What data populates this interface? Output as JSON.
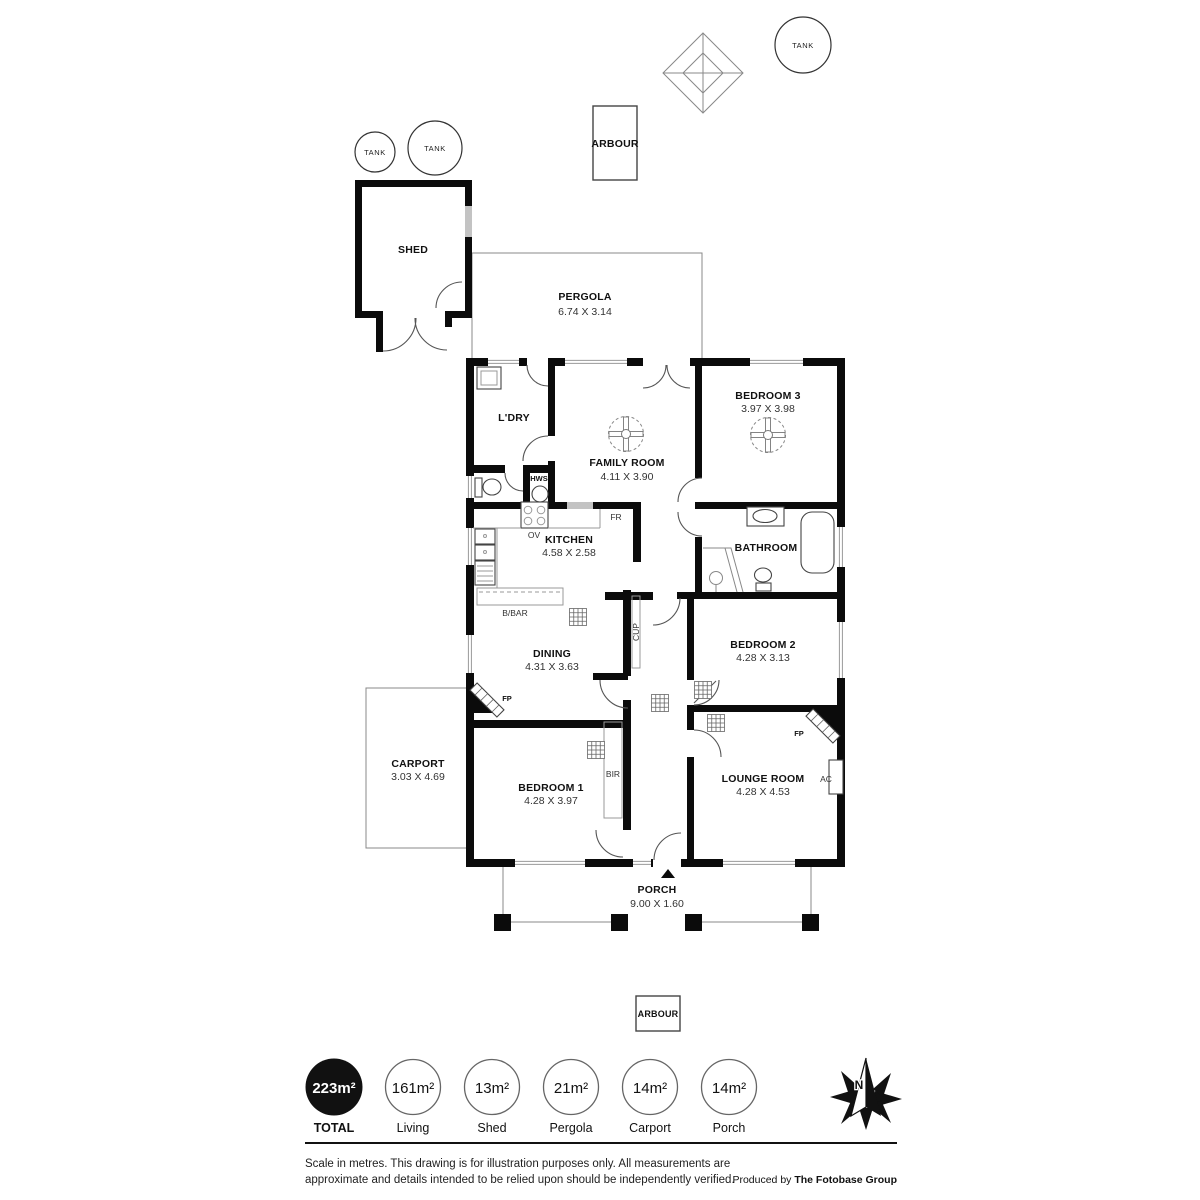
{
  "plan": {
    "tanks": [
      {
        "label": "TANK"
      },
      {
        "label": "TANK"
      },
      {
        "label": "TANK"
      }
    ],
    "arbour_top": {
      "label": "ARBOUR"
    },
    "arbour_bottom": {
      "label": "ARBOUR"
    },
    "shed": {
      "name": "SHED"
    },
    "pergola": {
      "name": "PERGOLA",
      "dims": "6.74 X 3.14"
    },
    "rooms": [
      {
        "name": "L'DRY",
        "dims": ""
      },
      {
        "name": "FAMILY ROOM",
        "dims": "4.11 X 3.90"
      },
      {
        "name": "BEDROOM 3",
        "dims": "3.97 X 3.98"
      },
      {
        "name": "KITCHEN",
        "dims": "4.58 X 2.58"
      },
      {
        "name": "BATHROOM",
        "dims": ""
      },
      {
        "name": "DINING",
        "dims": "4.31 X 3.63"
      },
      {
        "name": "BEDROOM 2",
        "dims": "4.28 X 3.13"
      },
      {
        "name": "BEDROOM 1",
        "dims": "4.28 X 3.97"
      },
      {
        "name": "LOUNGE ROOM",
        "dims": "4.28 X 4.53"
      },
      {
        "name": "CARPORT",
        "dims": "3.03 X 4.69"
      }
    ],
    "porch": {
      "name": "PORCH",
      "dims": "9.00 X 1.60"
    },
    "fixtures": {
      "hws": "HWS",
      "ov": "OV",
      "fr": "FR",
      "bbar": "B/BAR",
      "cup": "CUP",
      "fp": "FP",
      "bir": "BIR",
      "ac": "AC"
    }
  },
  "legend": {
    "items": [
      {
        "value": "223m²",
        "label": "TOTAL"
      },
      {
        "value": "161m²",
        "label": "Living"
      },
      {
        "value": "13m²",
        "label": "Shed"
      },
      {
        "value": "21m²",
        "label": "Pergola"
      },
      {
        "value": "14m²",
        "label": "Carport"
      },
      {
        "value": "14m²",
        "label": "Porch"
      }
    ]
  },
  "compass": {
    "north_label": "N"
  },
  "footer": {
    "disclaimer_line1": "Scale in metres. This drawing is for illustration purposes only. All measurements are",
    "disclaimer_line2": "approximate and details intended to be relied upon should be independently verified.",
    "produced_by_prefix": "Produced by ",
    "produced_by_brand": "The Fotobase Group"
  },
  "colors": {
    "wall": "#0b0b0b",
    "line": "#555555",
    "background": "#ffffff"
  }
}
